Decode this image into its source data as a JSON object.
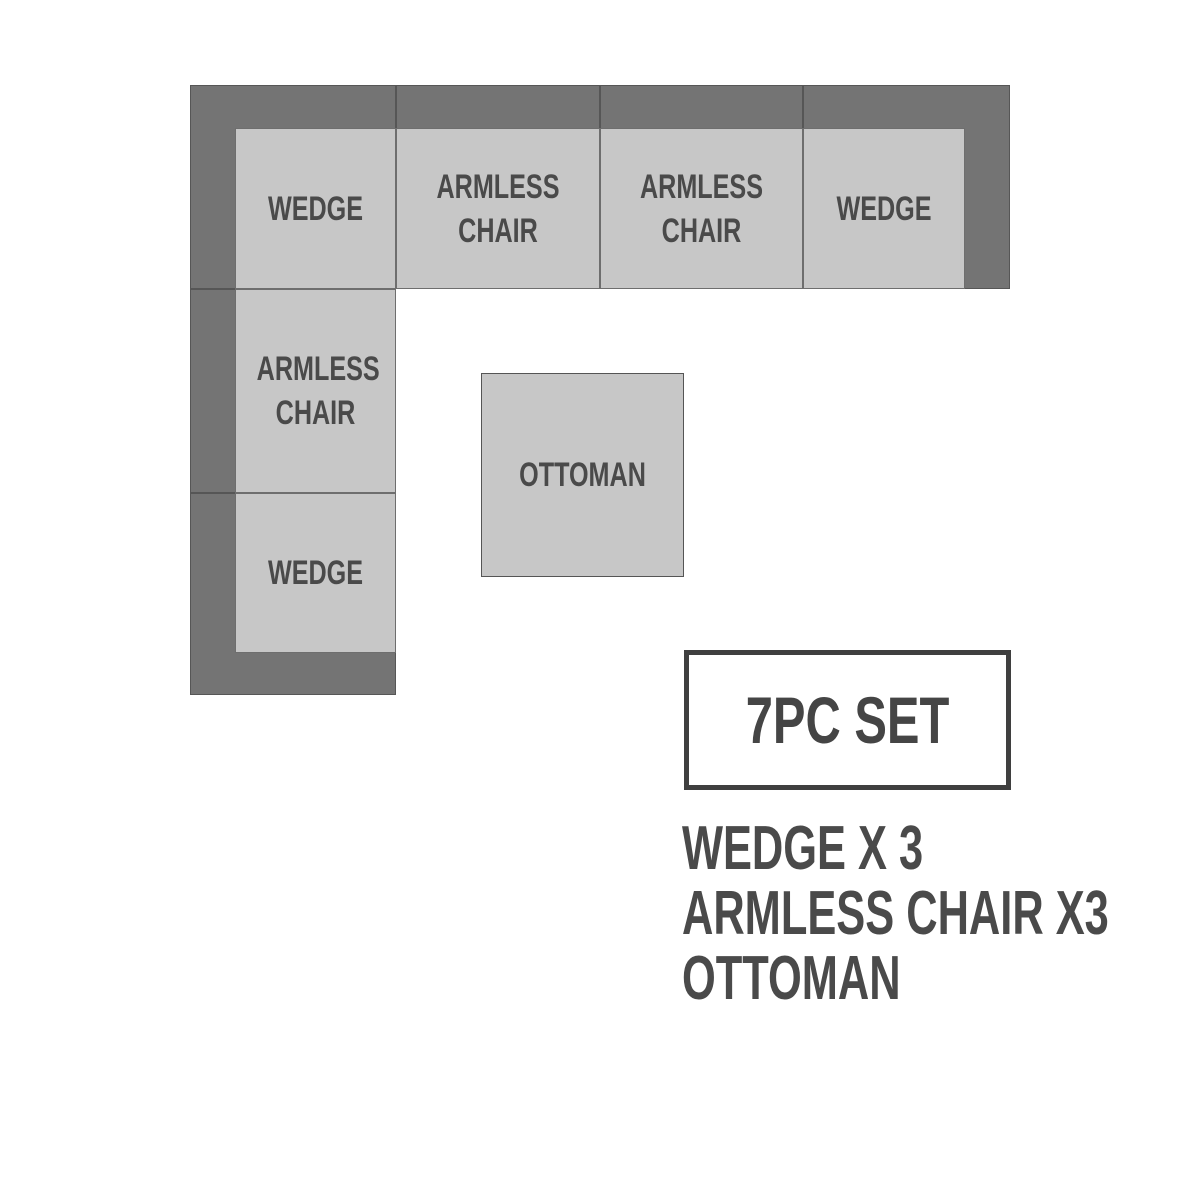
{
  "diagram": {
    "type": "sectional-sofa-floorplan",
    "palette": {
      "backrest_gray": "#747474",
      "seat_gray": "#c7c7c7",
      "outline_gray": "#565656",
      "text_gray": "#4a4a4a",
      "background": "#ffffff"
    },
    "pieces": [
      {
        "id": "wedge-top-left",
        "label": "WEDGE"
      },
      {
        "id": "armless-chair-top-1",
        "label": "ARMLESS CHAIR"
      },
      {
        "id": "armless-chair-top-2",
        "label": "ARMLESS CHAIR"
      },
      {
        "id": "wedge-top-right",
        "label": "WEDGE"
      },
      {
        "id": "armless-chair-left",
        "label": "ARMLESS CHAIR"
      },
      {
        "id": "wedge-bottom-left",
        "label": "WEDGE"
      },
      {
        "id": "ottoman",
        "label": "OTTOMAN"
      }
    ]
  },
  "legend": {
    "title": "7PC SET",
    "items": [
      {
        "label": "WEDGE X 3"
      },
      {
        "label": "ARMLESS CHAIR X3"
      },
      {
        "label": "OTTOMAN"
      }
    ]
  }
}
